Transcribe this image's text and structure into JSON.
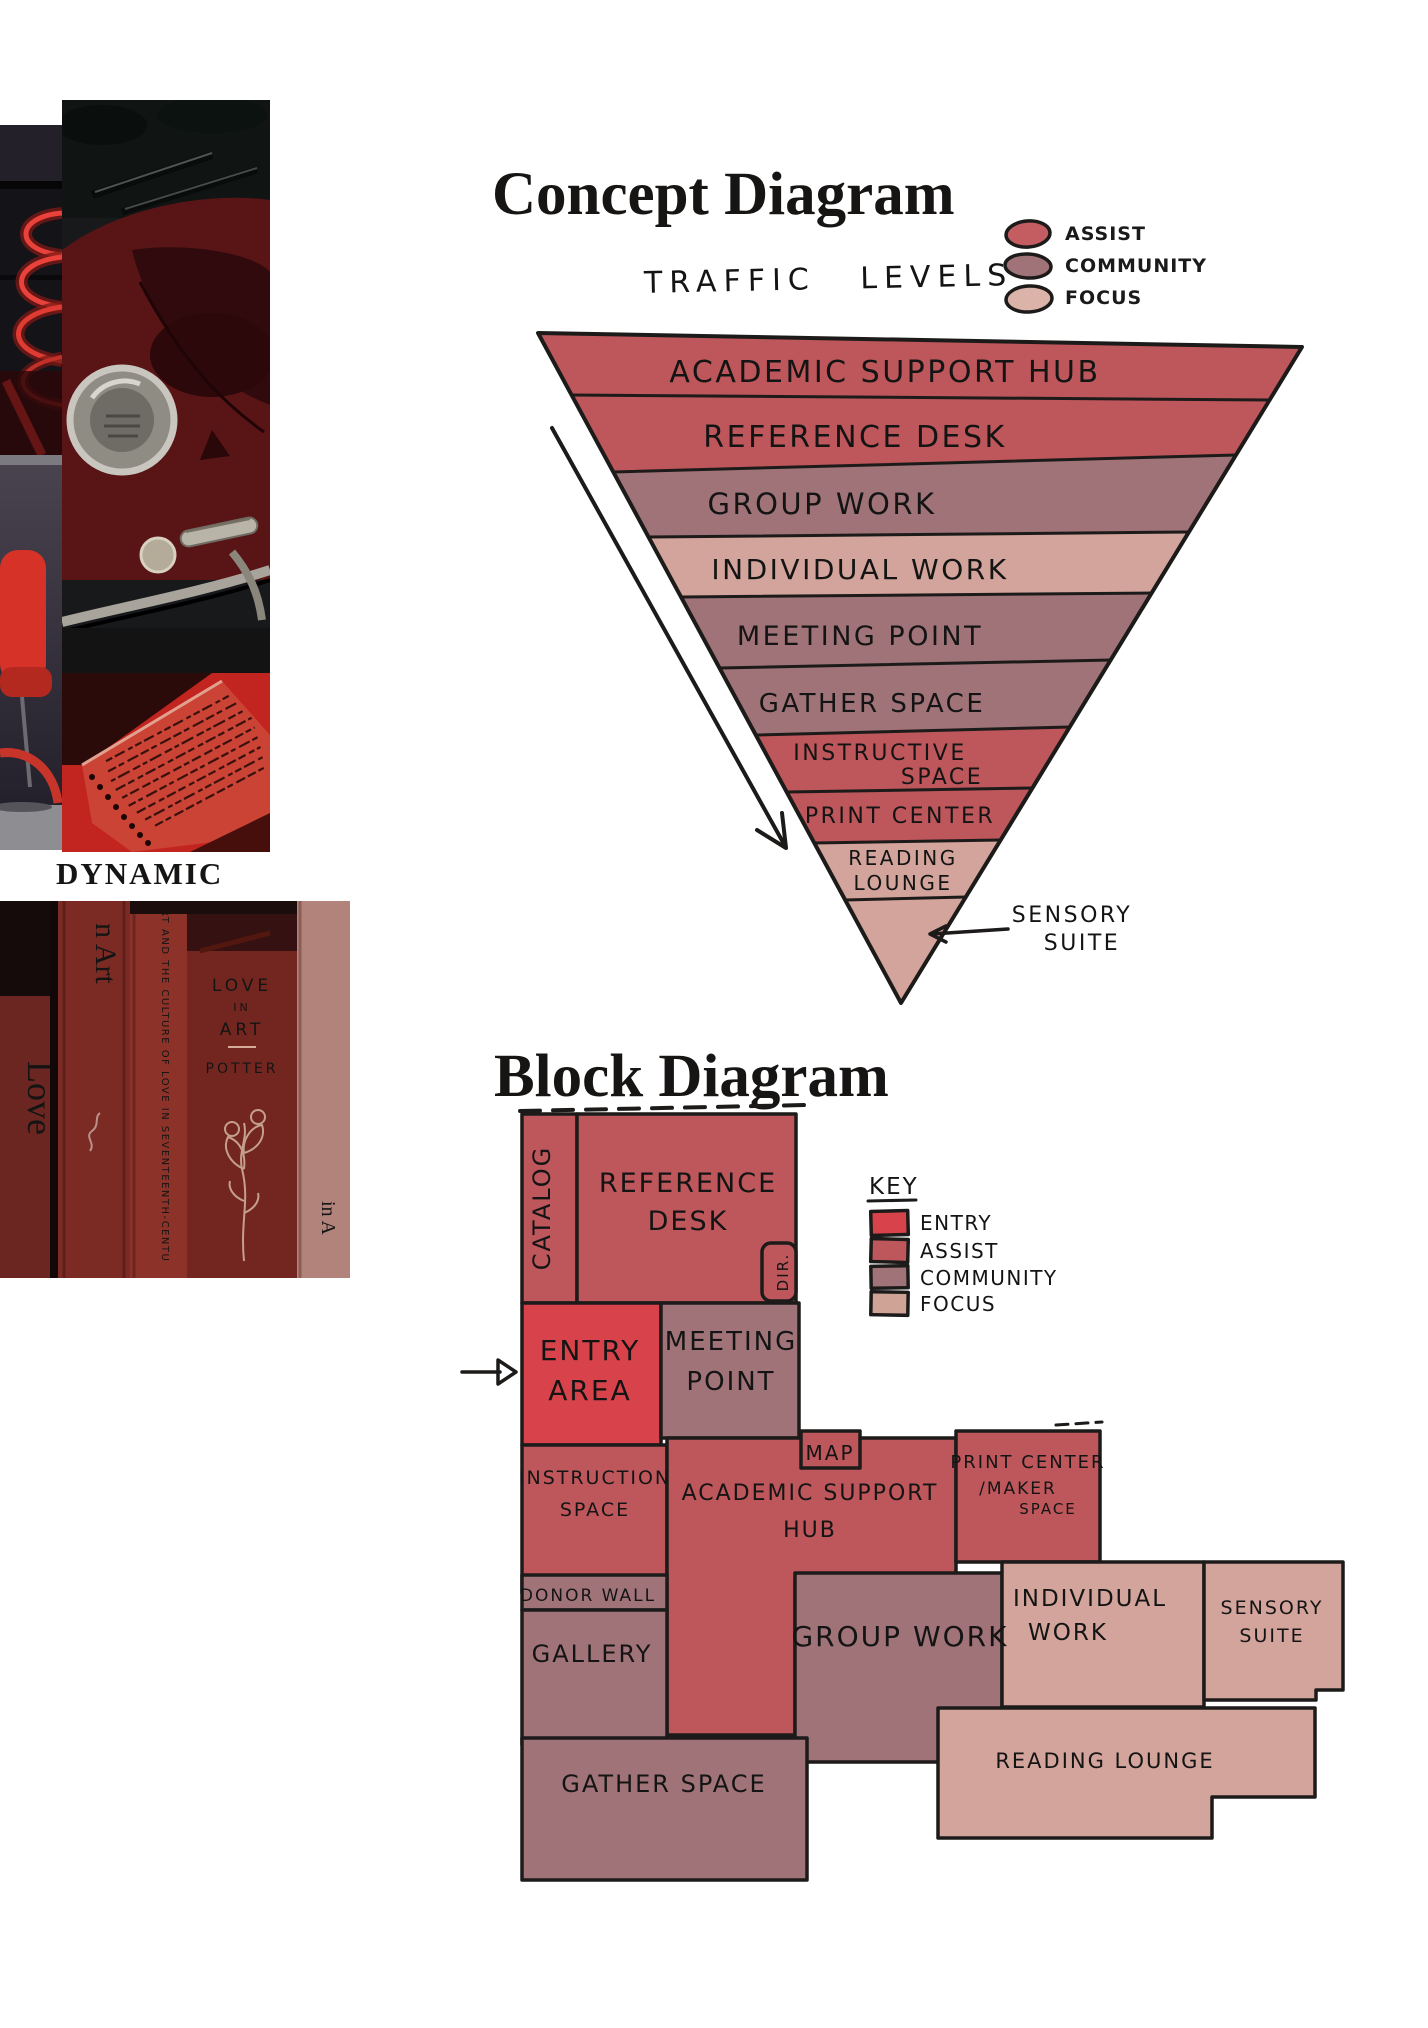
{
  "palette": {
    "ink": "#1d1b1a",
    "entry": "#d8434b",
    "assist": "#bd575b",
    "community": "#a07378",
    "focus": "#d2a49b",
    "paper": "#ffffff"
  },
  "moodboard": {
    "label": "DYNAMIC",
    "books": {
      "spine_love": "Love",
      "spine_n_art": "n Art",
      "spine_culture": "RT AND THE CULTURE OF LOVE IN SEVENTEENTH-CENTU",
      "spine_love_in": "LOVE",
      "spine_in": "IN",
      "spine_art": "ART",
      "spine_potter": "POTTER",
      "spine_in_a": "in A"
    }
  },
  "concept": {
    "title": "Concept Diagram",
    "subtitle": "TRAFFIC LEVELS",
    "legend": [
      {
        "label": "ASSIST",
        "color": "#c45d61"
      },
      {
        "label": "COMMUNITY",
        "color": "#a07378"
      },
      {
        "label": "FOCUS",
        "color": "#dcb3a9"
      }
    ],
    "levels": [
      {
        "label": "ACADEMIC SUPPORT HUB"
      },
      {
        "label": "REFERENCE DESK"
      },
      {
        "label": "GROUP WORK"
      },
      {
        "label": "INDIVIDUAL WORK"
      },
      {
        "label": "MEETING POINT"
      },
      {
        "label": "GATHER SPACE"
      },
      {
        "label": "INSTRUCTIVE",
        "label2": "SPACE"
      },
      {
        "label": "PRINT CENTER"
      },
      {
        "label": "READING",
        "label2": "LOUNGE"
      },
      {
        "label": "SENSORY",
        "label2": "SUITE"
      }
    ]
  },
  "block": {
    "title": "Block Diagram",
    "key": {
      "title": "KEY",
      "items": [
        {
          "label": "ENTRY",
          "color": "#d8434b"
        },
        {
          "label": "ASSIST",
          "color": "#bd575b"
        },
        {
          "label": "COMMUNITY",
          "color": "#a07378"
        },
        {
          "label": "FOCUS",
          "color": "#cfa396"
        }
      ]
    },
    "rooms": {
      "catalog": "CATALOG",
      "reference_desk_1": "REFERENCE",
      "reference_desk_2": "DESK",
      "dir": "DIR.",
      "entry_1": "ENTRY",
      "entry_2": "AREA",
      "meeting_1": "MEETING",
      "meeting_2": "POINT",
      "instruction_1": "INSTRUCTION",
      "instruction_2": "SPACE",
      "ash_1": "ACADEMIC SUPPORT",
      "ash_2": "HUB",
      "map": "MAP",
      "print_1": "PRINT CENTER",
      "print_2": "/MAKER",
      "print_3": "SPACE",
      "donor_wall": "DONOR WALL",
      "gallery": "GALLERY",
      "group_work": "GROUP WORK",
      "individual_1": "INDIVIDUAL",
      "individual_2": "WORK",
      "sensory_1": "SENSORY",
      "sensory_2": "SUITE",
      "gather": "GATHER SPACE",
      "reading": "READING LOUNGE"
    }
  }
}
